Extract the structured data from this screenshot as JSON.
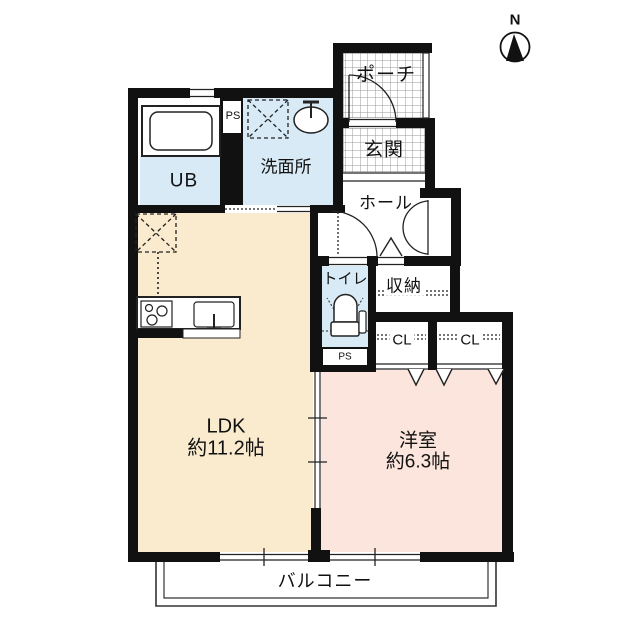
{
  "title": "floor-plan",
  "compass": {
    "label": "N"
  },
  "colors": {
    "wall": "#111111",
    "line": "#222222",
    "ldk": "#FAEBCE",
    "bedroom": "#FBE5DC",
    "wet": "#D7EAF6"
  },
  "rooms": {
    "porch": {
      "label": "ポーチ"
    },
    "entrance": {
      "label": "玄関"
    },
    "washroom": {
      "label": "洗面所"
    },
    "bath": {
      "label": "UB"
    },
    "ps_top": {
      "label": "PS"
    },
    "hall": {
      "label": "ホール"
    },
    "toilet": {
      "label": "トイレ"
    },
    "ps_bottom": {
      "label": "PS"
    },
    "storage": {
      "label": "収納"
    },
    "closet1": {
      "label": "CL"
    },
    "closet2": {
      "label": "CL"
    },
    "ldk": {
      "label": "LDK",
      "area": "約11.2帖"
    },
    "bedroom": {
      "label": "洋室",
      "area": "約6.3帖"
    },
    "balcony": {
      "label": "バルコニー"
    }
  }
}
